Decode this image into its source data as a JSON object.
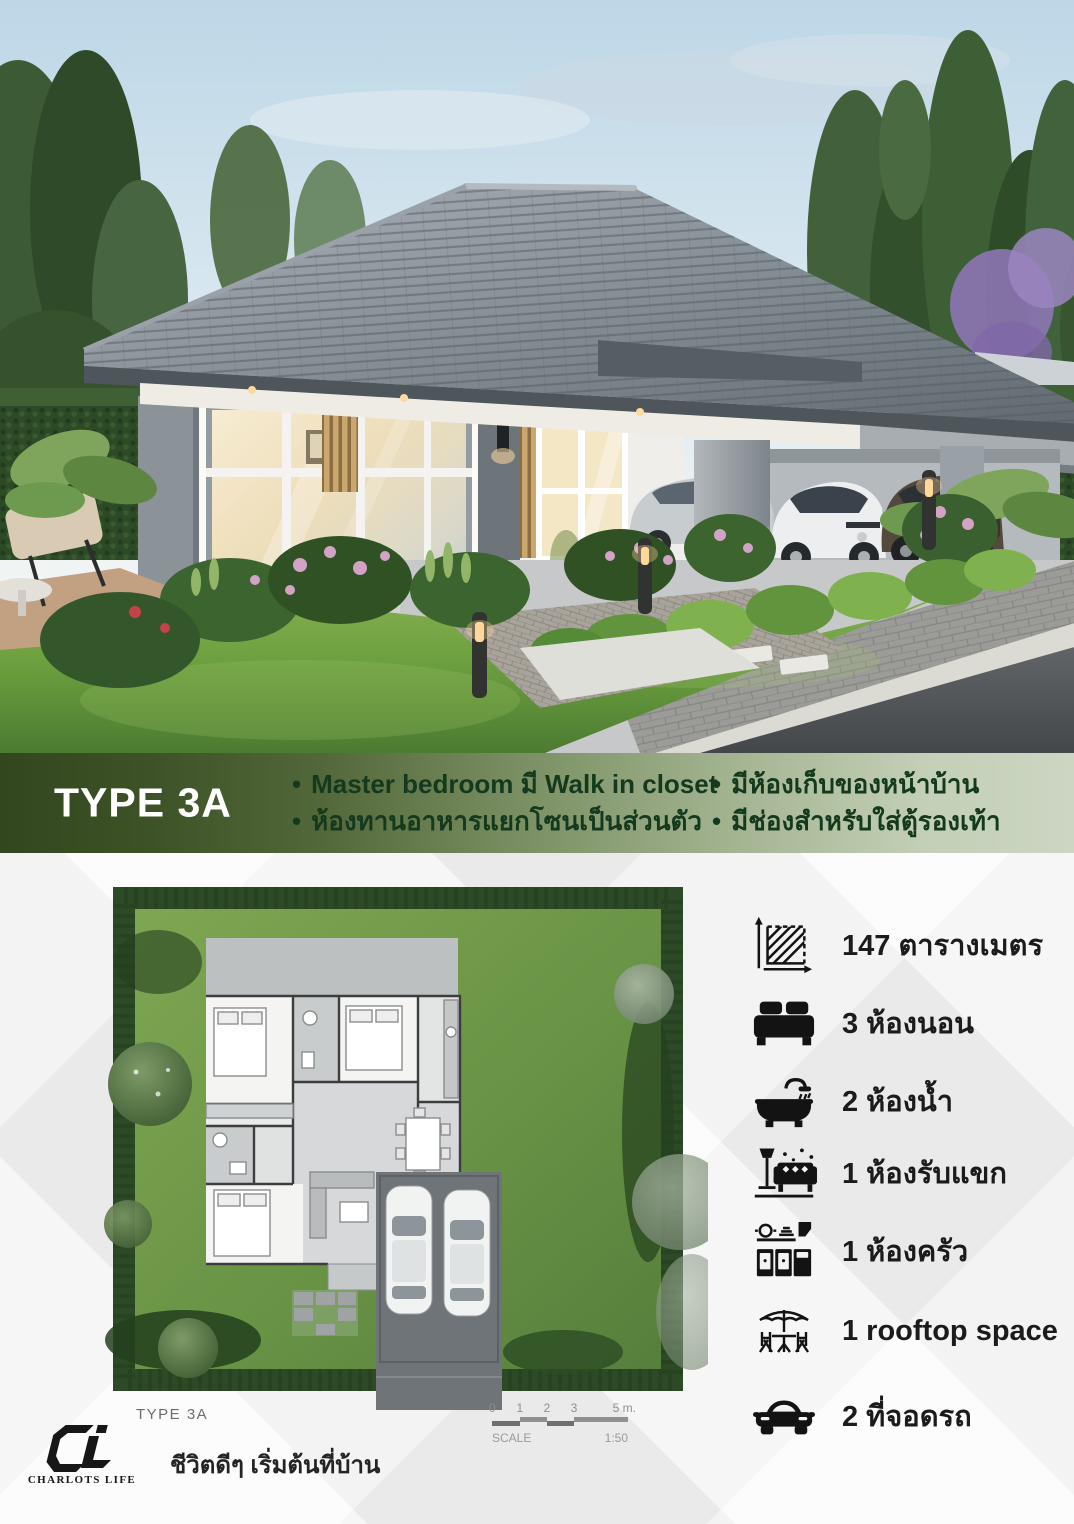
{
  "band": {
    "type_label": "TYPE 3A",
    "bullets_left": [
      "Master bedroom มี Walk in closet",
      "ห้องทานอาหารแยกโซนเป็นส่วนตัว"
    ],
    "bullets_right": [
      "มีห้องเก็บของหน้าบ้าน",
      "มีช่องสำหรับใส่ตู้รองเท้า"
    ],
    "colors": {
      "left": "#33471f",
      "right": "#ccd6c3",
      "bullet_text": "#14391d",
      "title_text": "#ffffff"
    }
  },
  "features": {
    "items": [
      {
        "icon": "area-icon",
        "label": "147 ตารางเมตร"
      },
      {
        "icon": "bed-icon",
        "label": "3 ห้องนอน"
      },
      {
        "icon": "bath-icon",
        "label": "2 ห้องน้ำ"
      },
      {
        "icon": "sofa-icon",
        "label": "1 ห้องรับแขก"
      },
      {
        "icon": "kitchen-icon",
        "label": "1 ห้องครัว"
      },
      {
        "icon": "umbrella-icon",
        "label": "1 rooftop space"
      },
      {
        "icon": "car-icon",
        "label": "2 ที่จอดรถ"
      }
    ]
  },
  "floorplan": {
    "type_label": "TYPE 3A",
    "scale": {
      "label": "SCALE",
      "ratio": "1:50",
      "ticks": [
        "0",
        "1",
        "2",
        "3",
        "5 m."
      ]
    }
  },
  "brand": {
    "monogram": "CL",
    "name": "CHARLOTS LIFE",
    "tagline": "ชีวิตดีๆ เริ่มต้นที่บ้าน"
  }
}
